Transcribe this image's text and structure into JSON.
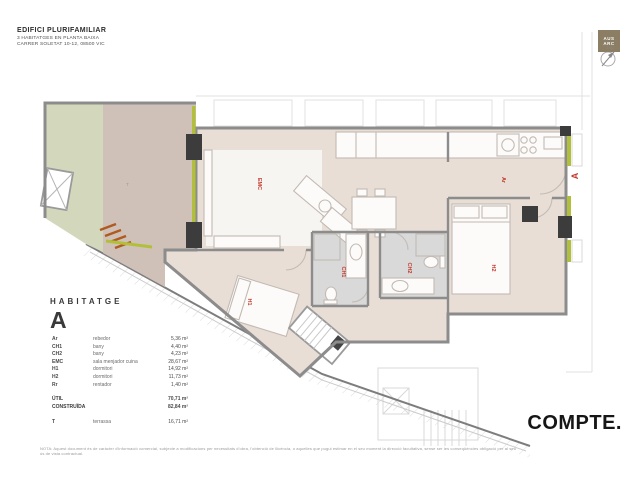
{
  "sheet": {
    "title": "EDIFICI PLURIFAMILIAR",
    "subtitle1": "3 HABITATGES EN PLANTA BAIXA",
    "subtitle2": "CARRER SOLETAT 10-12, 08500 VIC"
  },
  "stamp": {
    "logo_line1": "AUS",
    "logo_line2": "ARC",
    "scale": "1:50"
  },
  "legend": {
    "heading": "HABITATGE",
    "unit": "A",
    "rows": [
      {
        "code": "Ar",
        "name": "rebedor",
        "area": "5,36 m²"
      },
      {
        "code": "CH1",
        "name": "bany",
        "area": "4,40 m²"
      },
      {
        "code": "CH2",
        "name": "bany",
        "area": "4,23 m²"
      },
      {
        "code": "EMC",
        "name": "sala menjador cuina",
        "area": "28,67 m²"
      },
      {
        "code": "H1",
        "name": "dormitori",
        "area": "14,92 m²"
      },
      {
        "code": "H2",
        "name": "dormitori",
        "area": "11,73 m²"
      },
      {
        "code": "Rr",
        "name": "rentador",
        "area": "1,40 m²"
      }
    ],
    "totals": [
      {
        "label": "ÚTIL",
        "value": "70,71 m²"
      },
      {
        "label": "CONSTRUÏDA",
        "value": "82,84 m²"
      }
    ],
    "terrace_row": {
      "code": "T",
      "name": "terrassa",
      "area": "16,71 m²"
    }
  },
  "plan": {
    "labels": {
      "emc": "EMC",
      "ar": "Ar",
      "h1": "H1",
      "h2": "H2",
      "ch1": "CH1",
      "ch2": "CH2",
      "terrace": "T"
    },
    "entry_marker": "A"
  },
  "footer": {
    "note": "NOTA: Aquest document és de caràcter d'informació comercial, subjecte a modificacions per necessitats d'obra, l'obtenció de llicència, o aquelles que pugui estimar en el seu moment la direcció facultativa, sense ser les conseqüències obligació per al seu ús de vista contractual.",
    "brand": "COMPTE."
  },
  "colors": {
    "terrace_green": "#d3d8bd",
    "terrace_paving": "#cfc1b8",
    "apartment_floor": "#e8ded6",
    "living_floor": "#f7f5f2",
    "bath_floor": "#d9d9d9",
    "wall_gray": "#8c8c8c",
    "pillar_dark": "#3c3c3c",
    "window_green": "#b2bf3a",
    "steps_orange": "#b05a20",
    "label_red": "#c0392b"
  }
}
